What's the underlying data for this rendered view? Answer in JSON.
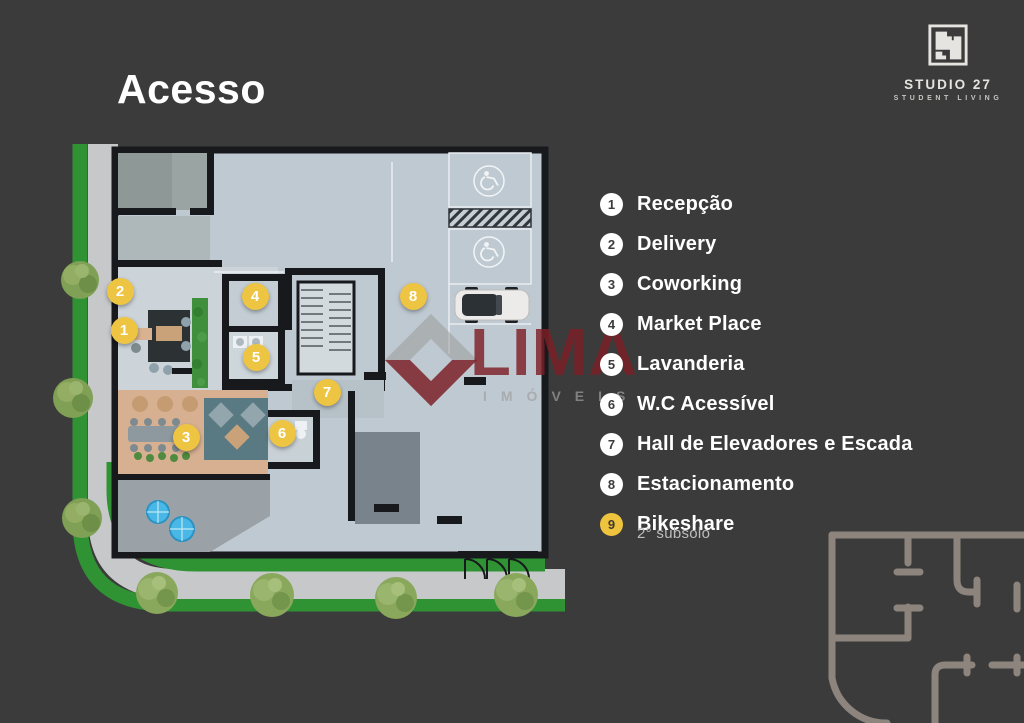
{
  "header": {
    "title": "Acesso"
  },
  "logo": {
    "name": "STUDIO 27",
    "tagline": "STUDENT LIVING"
  },
  "legend": {
    "items": [
      {
        "num": "1",
        "label": "Recepção",
        "circle_style": "white"
      },
      {
        "num": "2",
        "label": "Delivery",
        "circle_style": "white"
      },
      {
        "num": "3",
        "label": "Coworking",
        "circle_style": "white"
      },
      {
        "num": "4",
        "label": "Market Place",
        "circle_style": "white"
      },
      {
        "num": "5",
        "label": "Lavanderia",
        "circle_style": "white"
      },
      {
        "num": "6",
        "label": "W.C Acessível",
        "circle_style": "white"
      },
      {
        "num": "7",
        "label": "Hall de Elevadores e Escada",
        "circle_style": "white"
      },
      {
        "num": "8",
        "label": "Estacionamento",
        "circle_style": "white"
      },
      {
        "num": "9",
        "label": "Bikeshare",
        "circle_style": "yellow",
        "note": "2° subsolo"
      }
    ]
  },
  "plan": {
    "markers": [
      {
        "num": "1",
        "x": 72,
        "y": 198
      },
      {
        "num": "2",
        "x": 68,
        "y": 159
      },
      {
        "num": "3",
        "x": 134,
        "y": 305
      },
      {
        "num": "4",
        "x": 203,
        "y": 164
      },
      {
        "num": "5",
        "x": 204,
        "y": 225
      },
      {
        "num": "6",
        "x": 230,
        "y": 301
      },
      {
        "num": "7",
        "x": 275,
        "y": 260
      },
      {
        "num": "8",
        "x": 361,
        "y": 164
      }
    ],
    "icons": [
      "wheelchair-icon",
      "wheelchair-icon"
    ]
  },
  "watermark": {
    "title": "LIMA",
    "subtitle": "IMÓVEIS"
  },
  "colors": {
    "background": "#3b3b3b",
    "accent_yellow": "#eec443",
    "watermark_red": "#7c1e24",
    "grass_green": "#2f9334",
    "sidewalk_gray": "#c6c8c9",
    "floor_gray": "#bfc9d1",
    "wall_black": "#17191c",
    "sketch_gray": "#8d847e"
  }
}
